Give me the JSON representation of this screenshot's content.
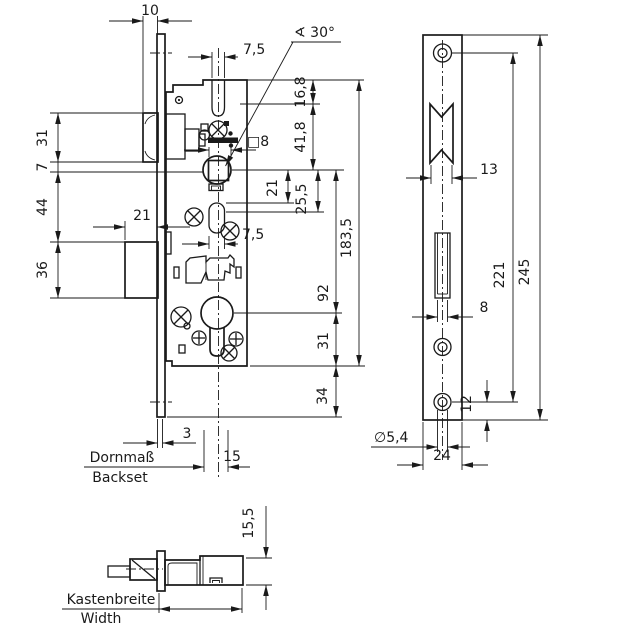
{
  "colors": {
    "line": "#1a1a1a",
    "background": "#ffffff"
  },
  "front_view": {
    "dim_10": "10",
    "dim_7_5_top": "7,5",
    "angle_label": "∢ 30°",
    "square_label": "□8",
    "dim_16_8": "16,8",
    "dim_41_8": "41,8",
    "dim_21_vertical": "21",
    "dim_25_5": "25,5",
    "dim_92": "92",
    "dim_183_5": "183,5",
    "dim_31_left": "31",
    "dim_7": "7",
    "dim_44": "44",
    "dim_36": "36",
    "dim_21_bolt": "21",
    "dim_7_5_bottom": "7,5",
    "dim_31_right": "31",
    "dim_34": "34",
    "dim_3": "3",
    "dim_15": "15",
    "backset_label_de": "Dornmaß",
    "backset_label_en": "Backset"
  },
  "faceplate_view": {
    "dim_13": "13",
    "dim_221": "221",
    "dim_245": "245",
    "dim_8": "8",
    "dim_12": "12",
    "dim_diameter": "∅5,4",
    "dim_24": "24"
  },
  "side_view": {
    "dim_15_5": "15,5",
    "width_label_de": "Kastenbreite",
    "width_label_en": "Width"
  }
}
